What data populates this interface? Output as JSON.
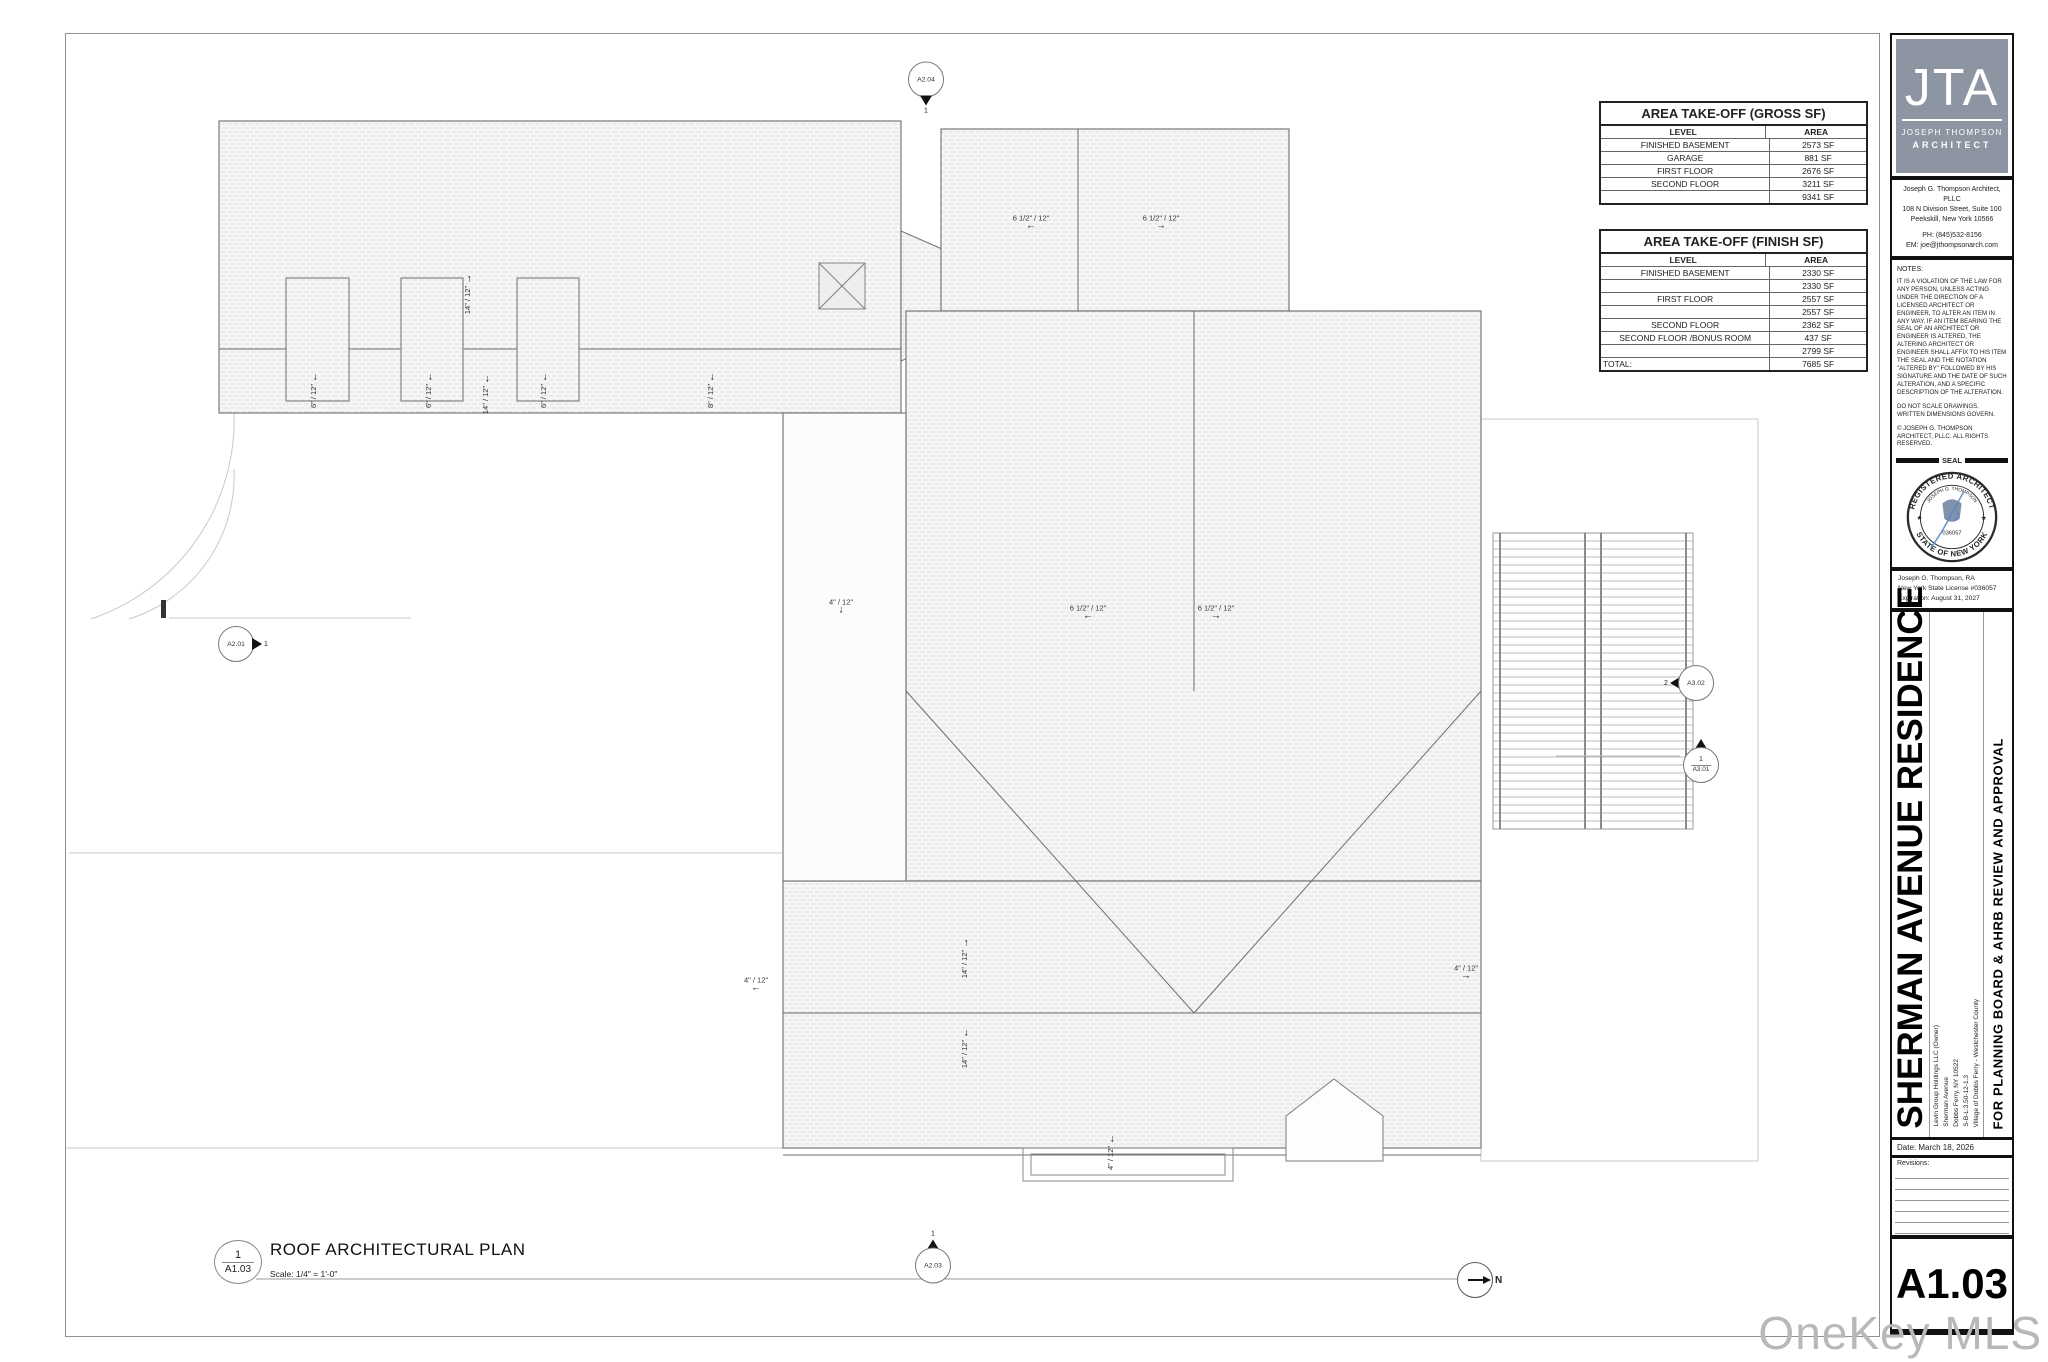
{
  "colors": {
    "logo_bg": "#8d95a3",
    "signature_blue": "#5b87c5",
    "bar_black": "#111111",
    "watermark_gray": "#b8b8b8"
  },
  "tables": {
    "gross": {
      "title": "AREA TAKE-OFF (GROSS SF)",
      "col_level": "LEVEL",
      "col_area": "AREA",
      "rows": [
        [
          "FINISHED BASEMENT",
          "2573 SF"
        ],
        [
          "GARAGE",
          "881 SF"
        ],
        [
          "FIRST FLOOR",
          "2676 SF"
        ],
        [
          "SECOND FLOOR",
          "3211 SF"
        ],
        [
          "",
          "9341 SF"
        ]
      ]
    },
    "finish": {
      "title": "AREA TAKE-OFF (FINISH SF)",
      "col_level": "LEVEL",
      "col_area": "AREA",
      "rows": [
        [
          "FINISHED BASEMENT",
          "2330 SF"
        ],
        [
          "",
          "2330 SF"
        ],
        [
          "FIRST FLOOR",
          "2557 SF"
        ],
        [
          "",
          "2557 SF"
        ],
        [
          "SECOND FLOOR",
          "2362 SF"
        ],
        [
          "SECOND FLOOR /BONUS ROOM",
          "437 SF"
        ],
        [
          "",
          "2799 SF"
        ],
        [
          "TOTAL:",
          "7685 SF"
        ]
      ]
    }
  },
  "title_block": {
    "logo": {
      "initials": "JTA",
      "name_line1": "JOSEPH THOMPSON",
      "name_line2": "ARCHITECT"
    },
    "firm": [
      "Joseph G. Thompson Architect, PLLC",
      "108 N Division Street, Suite 100",
      "Peekskill, New York 10566",
      "PH: (845)532-8156",
      "EM: joe@jthompsonarch.com"
    ],
    "notes_label": "NOTES:",
    "notes": [
      "IT IS A VIOLATION OF THE LAW FOR ANY PERSON, UNLESS ACTING UNDER THE DIRECTION OF A LICENSED ARCHITECT OR ENGINEER, TO ALTER AN ITEM IN ANY WAY. IF AN ITEM BEARING THE SEAL OF AN ARCHITECT OR ENGINEER IS ALTERED, THE ALTERING ARCHITECT OR ENGINEER SHALL AFFIX TO HIS ITEM THE SEAL AND THE NOTATION \"ALTERED BY\" FOLLOWED BY HIS SIGNATURE AND THE DATE OF SUCH ALTERATION, AND A SPECIFIC DESCRIPTION OF THE ALTERATION.",
      "DO NOT SCALE DRAWINGS.\nWRITTEN DIMENSIONS GOVERN.",
      "© JOSEPH G. THOMPSON ARCHITECT, PLLC.  ALL RIGHTS RESERVED."
    ],
    "seal_label": "SEAL",
    "seal": {
      "ring_top": "REGISTERED ARCHITECT",
      "name": "JOSEPH G. THOMPSON",
      "number": "036057",
      "ring_bottom": "STATE OF NEW YORK"
    },
    "license": [
      "Joseph G. Thompson, RA",
      "New York State License #036057",
      "Expiration: August 31, 2027"
    ],
    "project_title": "SHERMAN AVENUE RESIDENCE",
    "project_info": [
      "Levin Group Holdings LLC (Owner)",
      "Sherman Avenue",
      "Dobbs Ferry, NY 10522",
      "S-B-L:3.50-12-1.3",
      "Village of Dobbs Ferry - Westchester County"
    ],
    "submission": "FOR PLANNING BOARD & AHRB REVIEW AND APPROVAL",
    "date": "Date: March 18, 2026",
    "revisions_label": "Revisions:",
    "sheet_number": "A1.03"
  },
  "viewport": {
    "number": "1",
    "sheet": "A1.03",
    "title": "ROOF ARCHITECTURAL PLAN",
    "scale": "Scale:  1/4\" = 1'-0\"",
    "north_label": "N"
  },
  "plan": {
    "slopes": [
      {
        "text": "6 1/2\" / 12\"",
        "arrow": "left",
        "x": 965,
        "y": 188,
        "rot": false
      },
      {
        "text": "6 1/2\" / 12\"",
        "arrow": "right",
        "x": 1095,
        "y": 188,
        "rot": false
      },
      {
        "text": "14\" / 12\"",
        "arrow": "up",
        "x": 402,
        "y": 260,
        "rot": true
      },
      {
        "text": "6\" / 12\"",
        "arrow": "down",
        "x": 248,
        "y": 356,
        "rot": true
      },
      {
        "text": "6\" / 12\"",
        "arrow": "down",
        "x": 363,
        "y": 356,
        "rot": true
      },
      {
        "text": "14\" / 12\"",
        "arrow": "down",
        "x": 420,
        "y": 360,
        "rot": true
      },
      {
        "text": "6\" / 12\"",
        "arrow": "down",
        "x": 478,
        "y": 356,
        "rot": true
      },
      {
        "text": "8\" / 12\"",
        "arrow": "down",
        "x": 645,
        "y": 356,
        "rot": true
      },
      {
        "text": "4\" / 12\"",
        "arrow": "down",
        "x": 775,
        "y": 572,
        "rot": false
      },
      {
        "text": "6 1/2\" / 12\"",
        "arrow": "left",
        "x": 1022,
        "y": 578,
        "rot": false
      },
      {
        "text": "6 1/2\" / 12\"",
        "arrow": "right",
        "x": 1150,
        "y": 578,
        "rot": false
      },
      {
        "text": "4\" / 12\"",
        "arrow": "left",
        "x": 690,
        "y": 950,
        "rot": false
      },
      {
        "text": "14\" / 12\"",
        "arrow": "up",
        "x": 899,
        "y": 924,
        "rot": true
      },
      {
        "text": "14\" / 12\"",
        "arrow": "down",
        "x": 899,
        "y": 1014,
        "rot": true
      },
      {
        "text": "4\" / 12\"",
        "arrow": "right",
        "x": 1400,
        "y": 938,
        "rot": false
      },
      {
        "text": "4\" / 12\"",
        "arrow": "down",
        "x": 1045,
        "y": 1118,
        "rot": true
      }
    ],
    "markers": [
      {
        "label": "A2.04",
        "num": "1",
        "dir": "down",
        "x": 860,
        "y": 55
      },
      {
        "label": "A2.01",
        "num": "1",
        "dir": "right",
        "x": 178,
        "y": 610
      },
      {
        "label": "A3.02",
        "num": "2",
        "dir": "left",
        "x": 1622,
        "y": 649
      },
      {
        "label": "A3.01",
        "num": "1",
        "dir": "up-split",
        "x": 1635,
        "y": 727
      },
      {
        "label": "A2.03",
        "num": "1",
        "dir": "up",
        "x": 867,
        "y": 1222
      }
    ]
  },
  "watermark": "OneKey MLS"
}
